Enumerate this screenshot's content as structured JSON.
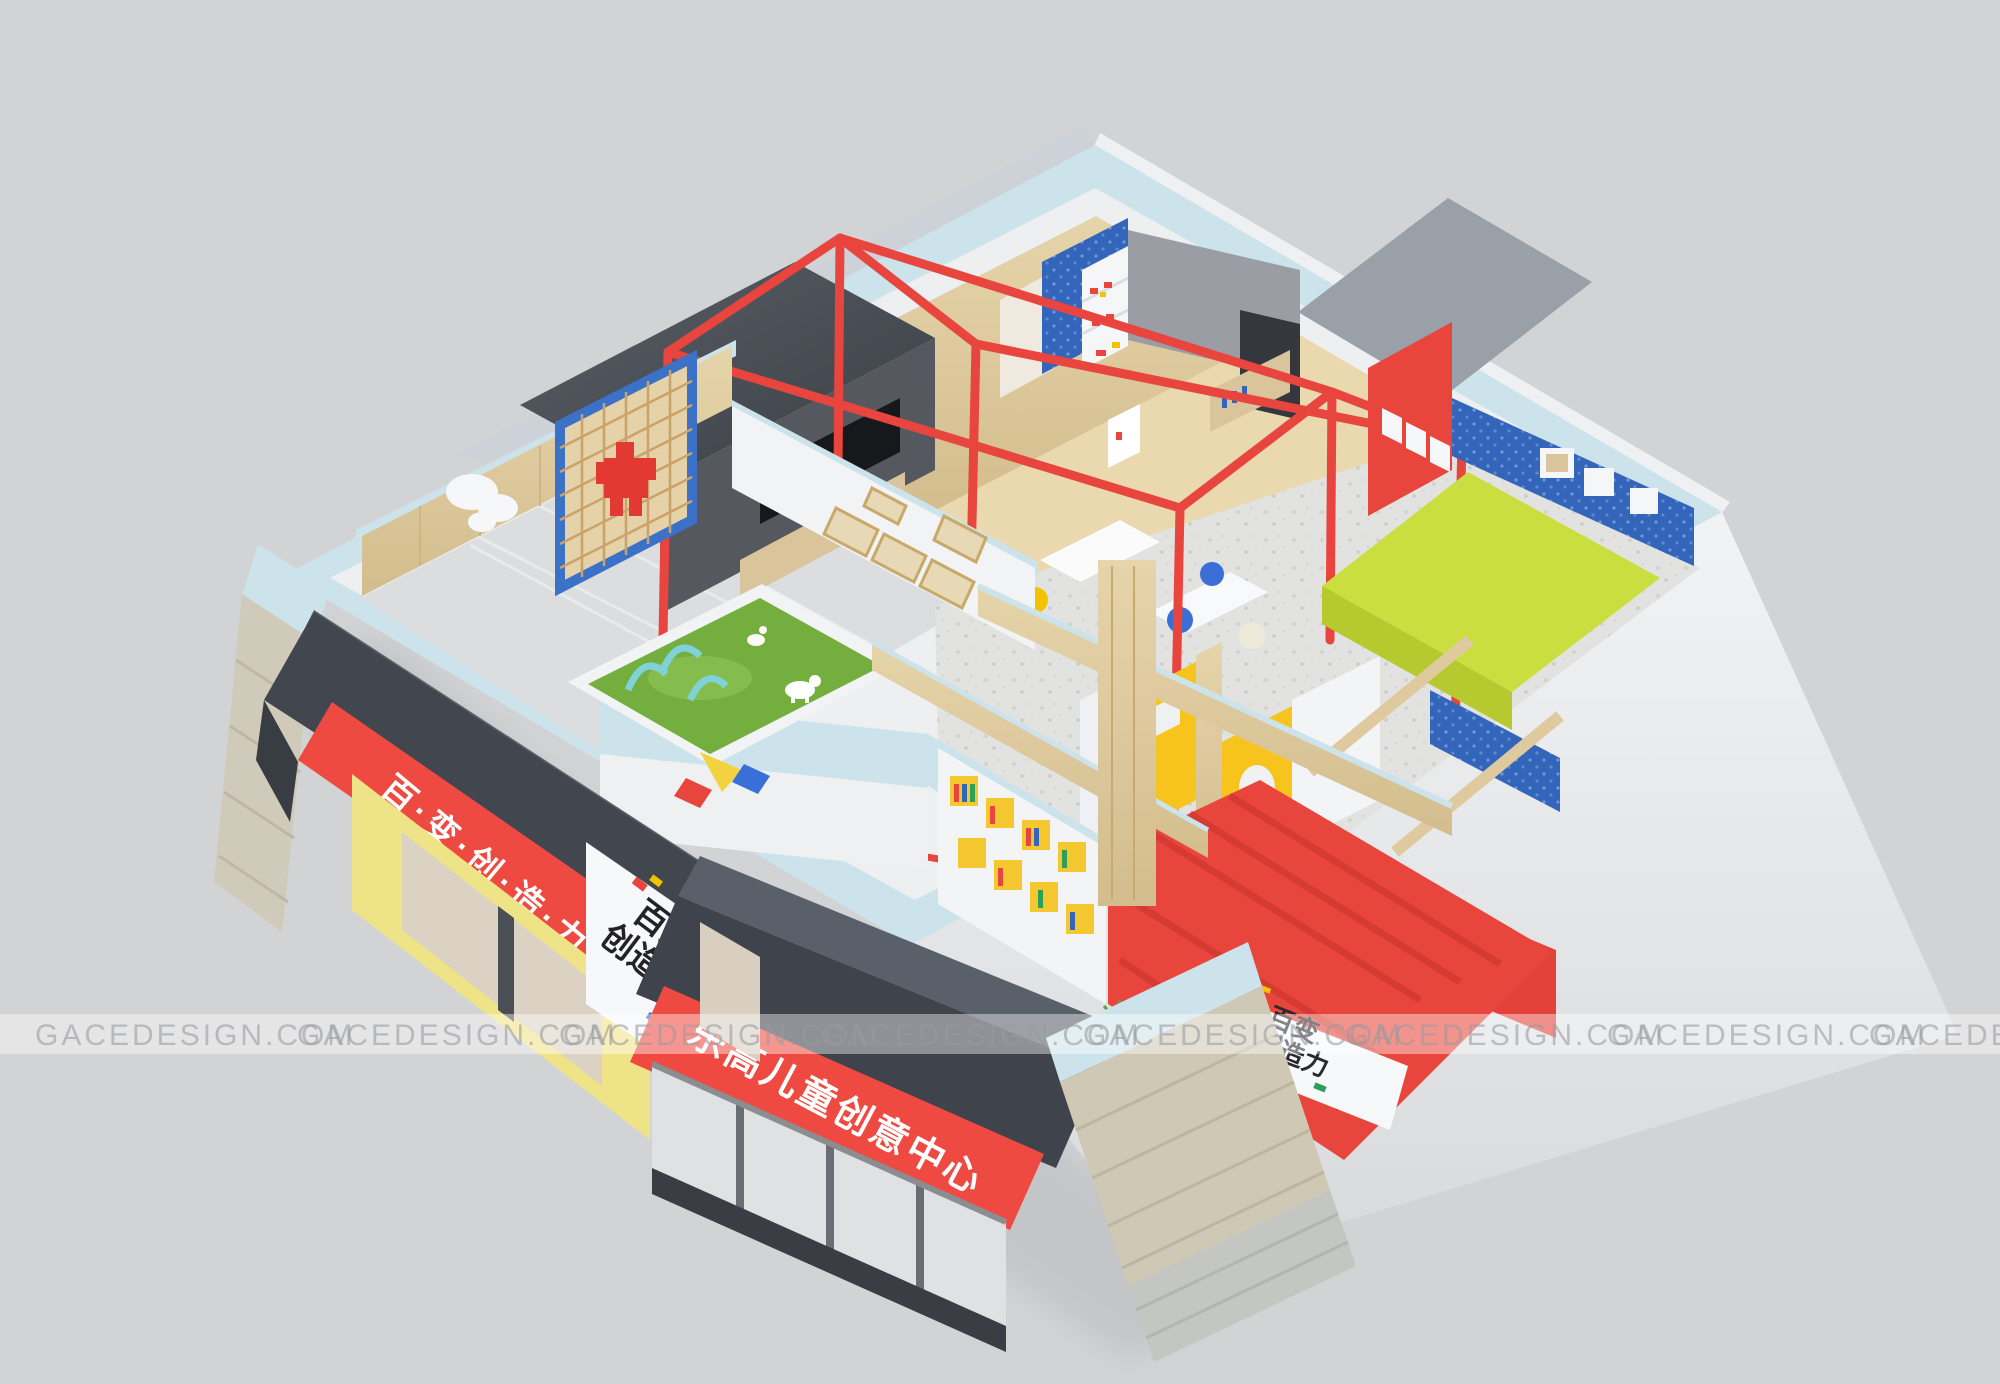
{
  "scene": {
    "type": "3d-interior-render",
    "subject": "children's creative center — isometric cutaway floor plan",
    "background_color": "#d2d3d5"
  },
  "watermark": {
    "text": "GACEDESIGN.COM",
    "repeat_count": 8,
    "text_color": "#97999e",
    "band_color": "rgba(255,255,255,0.42)"
  },
  "signs": {
    "main_storefront": {
      "text": "乐高儿童创意中心",
      "band_color": "#ef4a42",
      "text_color": "#ffffff"
    },
    "side_storefront": {
      "text": "百·变·创·造·力",
      "band_color": "#ef4a42",
      "text_color": "#ffffff"
    },
    "pillar_logo": {
      "line1": "百变",
      "line2": "创造力",
      "text_color": "#232327"
    },
    "reception_logo": {
      "line1": "百变",
      "line2": "创造力",
      "text_color": "#2a2a2e"
    }
  },
  "palette": {
    "background": "#d2d3d5",
    "wall_top_cyan": "#cde3eb",
    "sign_red": "#ef4a42",
    "accent_red": "#e8453d",
    "brick_blue": "#3365bb",
    "door_yellow": "#f6c41d",
    "storefront_yellow": "#efe387",
    "lime_green": "#cade3f",
    "turf_green": "#74ae3e",
    "wood": "#dfc99f",
    "charcoal": "#3f434b",
    "white_wall": "#f3f4f6"
  }
}
